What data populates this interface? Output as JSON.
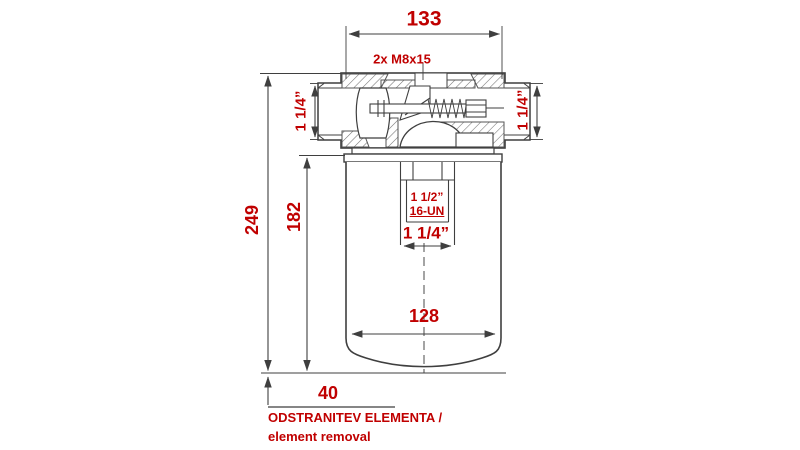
{
  "drawing": {
    "colors": {
      "annotation": "#c00000",
      "line": "#3f3f3f"
    },
    "dimensions": {
      "head_width": "133",
      "overall_height": "249",
      "element_height": "182",
      "canister_diameter": "128",
      "removal_clearance": "40"
    },
    "labels": {
      "bolt_spec": "2x M8x15",
      "port_left": "1 1/4”",
      "port_right": "1 1/4”",
      "thread_size": "1 1/2”",
      "thread_class": "16-UN",
      "center_port": "1 1/4”"
    },
    "notes": {
      "line1_sl": "ODSTRANITEV ELEMENTA /",
      "line2_en": "element removal"
    }
  }
}
